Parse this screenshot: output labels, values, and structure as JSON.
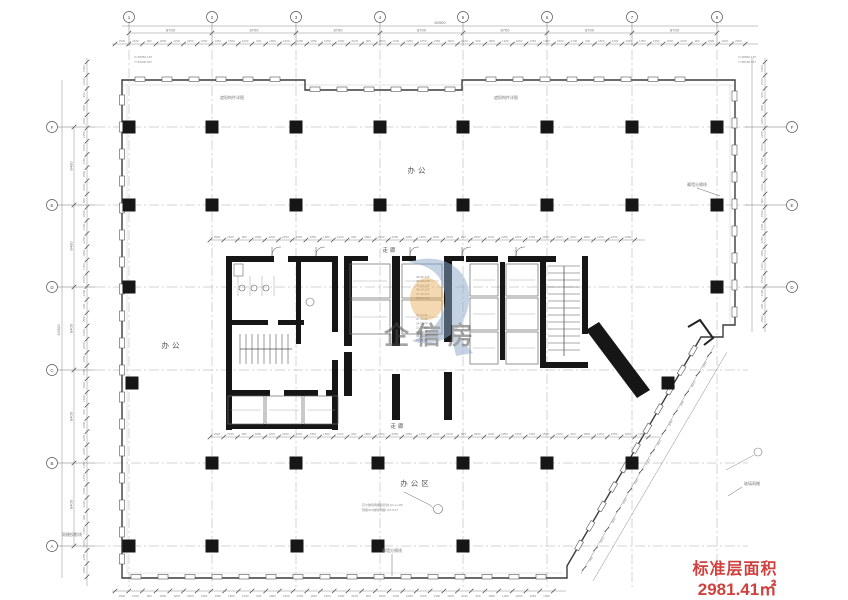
{
  "title": "标准层平面图",
  "area_box": {
    "label": "标准层面积",
    "value": "2981.41㎡",
    "color": "#d0413d"
  },
  "watermark": {
    "text": "企信房",
    "blue": "#8ba7ca",
    "orange": "#e3a44a",
    "red": "#c84b4b"
  },
  "rooms": {
    "office_top": "办公",
    "office_left": "办公",
    "office_bottom": "办公区",
    "corridor_top": "走廊",
    "corridor_bottom": "走廊"
  },
  "annotations": {
    "shade_detail_1": "遮阳构件详图",
    "shade_detail_2": "遮阳构件详图",
    "curtain_divider_bottom": "幕墙分隔线",
    "curtain_divider_right": "幕墙分隔线",
    "glass_canopy": "玻璃雨棚",
    "canopy_note_1": "高大玻璃雨棚投影线 1F(+1.05)",
    "canopy_note_2": "预留GF(玻璃雨棚) 2% 5.47",
    "corner_tl_1": "X=30852.145",
    "corner_tl_2": "Y=51206.307",
    "corner_tr_1": "X=30852.145",
    "corner_tr_2": "Y=58100.957",
    "canopy_left": "雨棚投影线",
    "levels_a": [
      "49.80-15F",
      "46.60-14F",
      "43.40-13F",
      "40.20-12F",
      "37.00-11F",
      "33.80-10F"
    ],
    "levels_b": [
      "30.60-9F",
      "27.40-8F",
      "24.20-7F",
      "21.00-6F",
      "17.80-5F",
      "14.60-4F",
      "11.40-3F"
    ]
  },
  "axes": {
    "top": {
      "labels": [
        "1",
        "2",
        "3",
        "4",
        "5",
        "6",
        "7",
        "8"
      ],
      "spans": [
        "8700",
        "8700",
        "8700",
        "8700",
        "8700",
        "8700",
        "8700"
      ],
      "total": "60900"
    },
    "left": {
      "labels": [
        "F",
        "E",
        "D",
        "C",
        "B",
        "A"
      ],
      "spans": [
        "8400",
        "8400",
        "8400",
        "8400",
        "8400"
      ],
      "total": "42000"
    },
    "right": {
      "labels": [
        "F",
        "E",
        "D"
      ]
    }
  },
  "dims": {
    "pattern": [
      "1500",
      "2100",
      "900",
      "1800",
      "1200",
      "2250",
      "1050",
      "1350"
    ]
  },
  "colors": {
    "wall": "#161616",
    "line": "#3c3c3c",
    "grid": "#a8a8a8",
    "dim": "#8a8a8a"
  }
}
